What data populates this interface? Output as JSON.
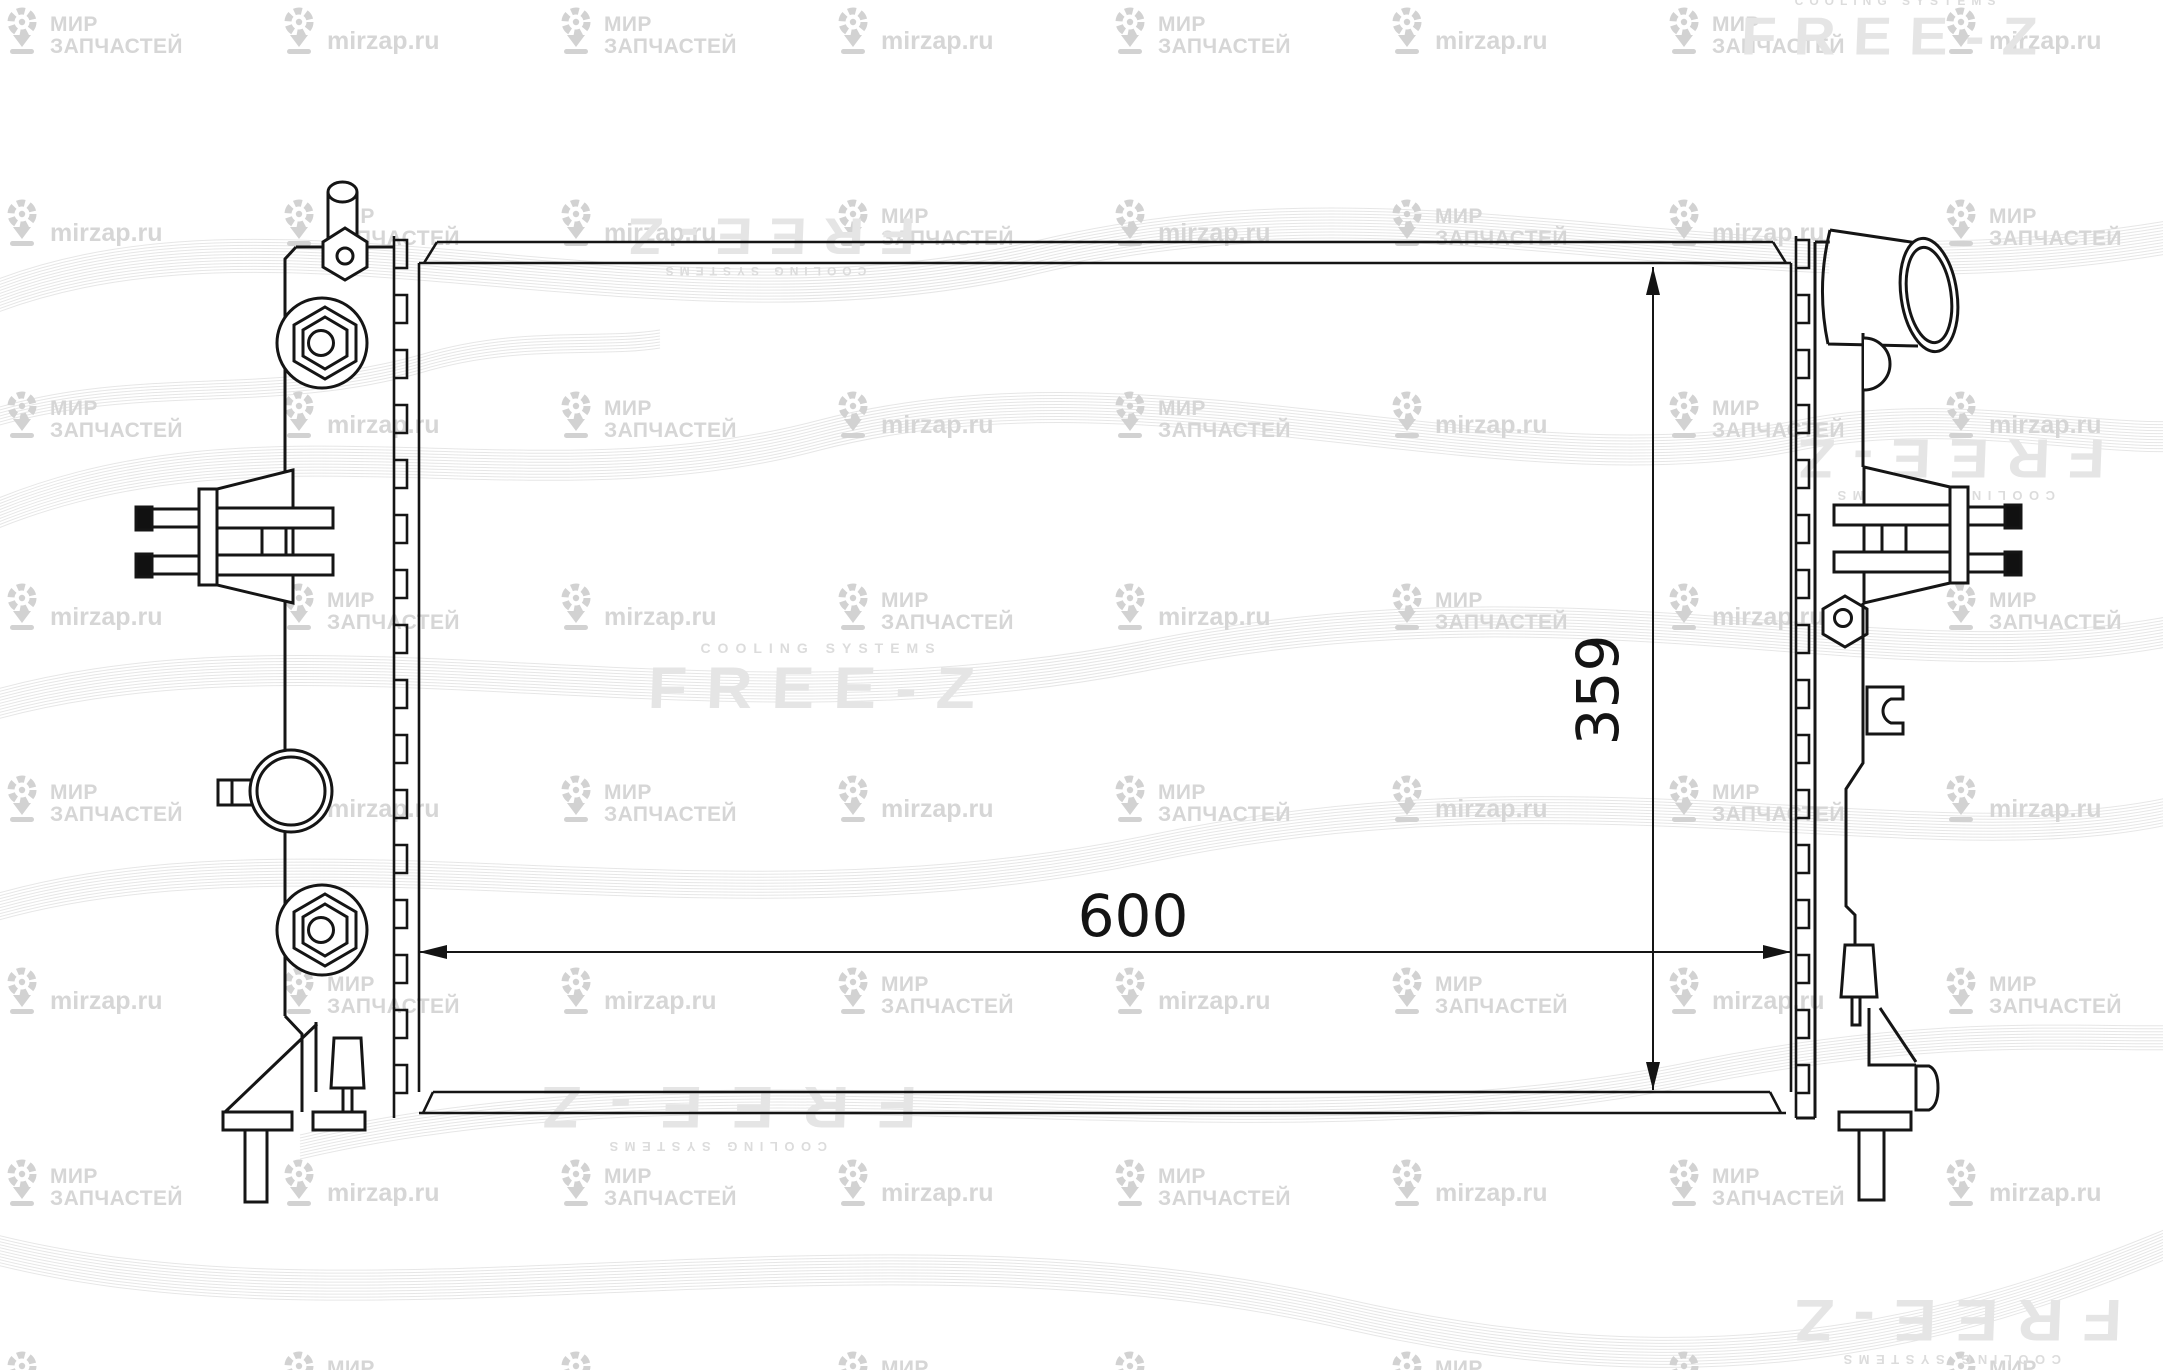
{
  "brand": {
    "name": "FREE-Z",
    "tagline": "COOLING SYSTEMS"
  },
  "watermark": {
    "store_line1": "МИР",
    "store_line2": "ЗАПЧАСТЕЙ",
    "site": "mirzap.ru"
  },
  "dimensions": {
    "width_mm": "600",
    "height_mm": "359"
  },
  "figure": {
    "type": "technical-line-drawing",
    "subject": "radiator front view with core, left tank with filler neck and fittings, right tank with inlet pipe and oil-cooler pipes"
  },
  "colors": {
    "line": "#151515",
    "watermark_gray": "#d6d6d6",
    "logo_gray": "#e5e5e5",
    "wave_gray": "#e4e4e4"
  }
}
